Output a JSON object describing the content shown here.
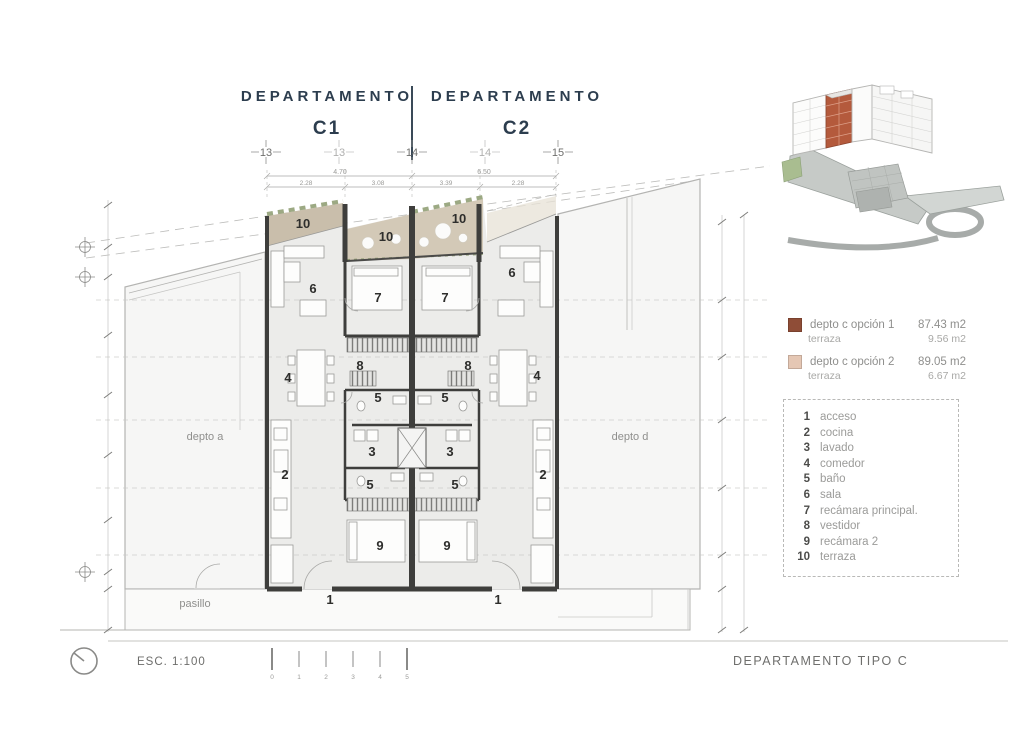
{
  "header": {
    "left": {
      "title": "DEPARTAMENTO",
      "unit": "C1"
    },
    "right": {
      "title": "DEPARTAMENTO",
      "unit": "C2"
    }
  },
  "grid_markers": [
    "13",
    "13",
    "14",
    "14",
    "15"
  ],
  "dimensions": {
    "top_primary": [
      "4.70",
      "6.50"
    ],
    "top_secondary": [
      "2.28",
      "3.08",
      "3.39",
      "2.28"
    ]
  },
  "plan": {
    "adjacent_left": "depto a",
    "adjacent_right": "depto d",
    "corridor": "pasillo",
    "c1": {
      "terraza_outer": "10",
      "terraza_inner": "10",
      "sala": "6",
      "recamara_principal": "7",
      "comedor": "4",
      "vestidor": "8",
      "bano_1": "5",
      "lavado": "3",
      "bano_2": "5",
      "cocina": "2",
      "recamara_2": "9",
      "acceso": "1"
    },
    "c2": {
      "terraza_inner": "10",
      "sala": "6",
      "recamara_principal": "7",
      "comedor": "4",
      "vestidor": "8",
      "bano_1": "5",
      "lavado": "3",
      "bano_2": "5",
      "cocina": "2",
      "recamara_2": "9",
      "acceso": "1"
    }
  },
  "area_summary": {
    "options": [
      {
        "label": "depto c opción 1",
        "area": "87.43 m2",
        "sub_label": "terraza",
        "sub_area": "9.56 m2"
      },
      {
        "label": "depto c opción 2",
        "area": "89.05 m2",
        "sub_label": "terraza",
        "sub_area": "6.67 m2"
      }
    ]
  },
  "legend": {
    "items": [
      {
        "num": "1",
        "label": "acceso"
      },
      {
        "num": "2",
        "label": "cocina"
      },
      {
        "num": "3",
        "label": "lavado"
      },
      {
        "num": "4",
        "label": "comedor"
      },
      {
        "num": "5",
        "label": "baño"
      },
      {
        "num": "6",
        "label": "sala"
      },
      {
        "num": "7",
        "label": "recámara principal."
      },
      {
        "num": "8",
        "label": "vestidor"
      },
      {
        "num": "9",
        "label": "recámara 2"
      },
      {
        "num": "10",
        "label": "terraza"
      }
    ]
  },
  "footer": {
    "scale": "ESC. 1:100",
    "scale_ticks": [
      "0",
      "1",
      "2",
      "3",
      "4",
      "5"
    ],
    "sheet_title": "DEPARTAMENTO TIPO C"
  },
  "colors": {
    "title": "#2c3d4e",
    "wall": "#3e3e3c",
    "terraza_option1_swatch": "#8f4d37",
    "terraza_option2_swatch": "#e5c7b4",
    "terraza_fill_dark": "#c9beab",
    "terraza_fill_mid": "#d3c9b7",
    "terraza_fill_light": "#e7e1d6",
    "planter_green": "#8b9a6d",
    "brick_3d": "#b45a3c"
  }
}
